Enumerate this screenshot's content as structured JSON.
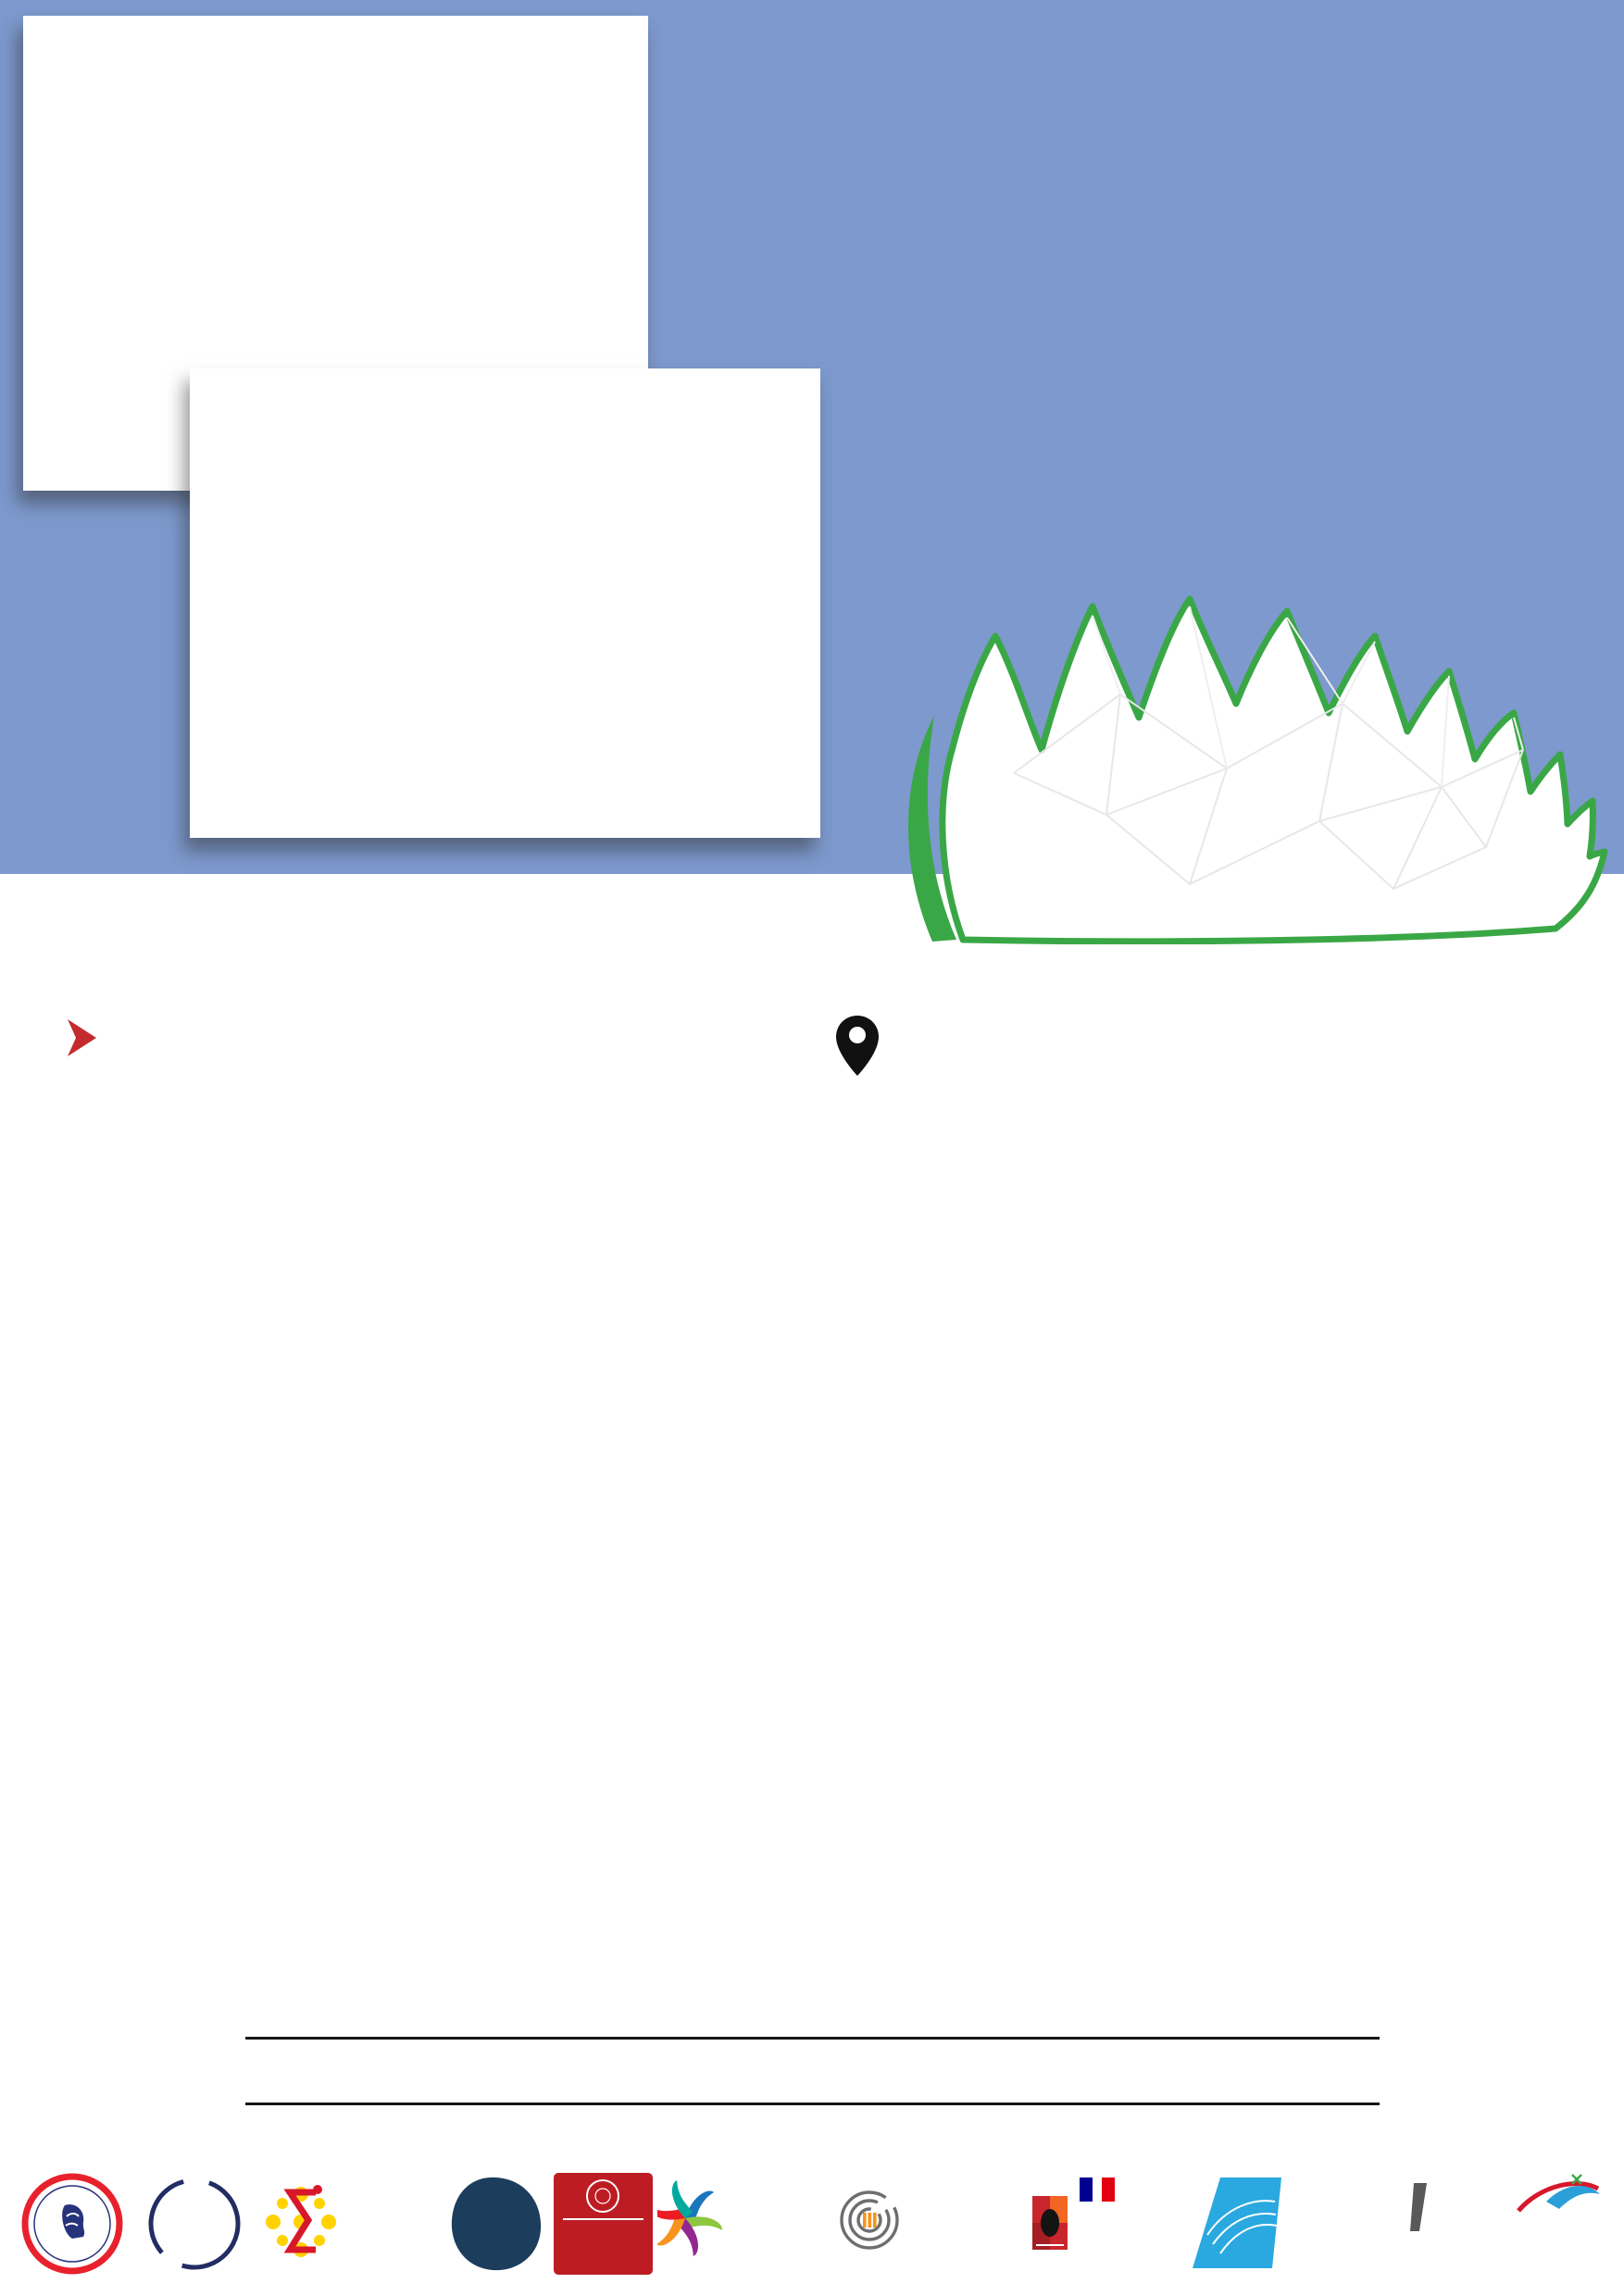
{
  "header": {
    "masterclass": "MASTERCLASS",
    "mint": "MINT",
    "year": "2024"
  },
  "logo": {
    "wordmark": "Mint",
    "subtitle": "Mathematics and Interactions in Toulouse"
  },
  "sessions_header": {
    "label": "SESSIONS",
    "location_line1": "Amphi Schwartz, building 1R3,",
    "location_line2": "Institut de mathématiques of Toulouse"
  },
  "date_header": "January 25th, 2024",
  "sessions": [
    {
      "time": "14h00-15h15",
      "speaker": "Jean-François Coulombel",
      "topic": "Around the central limit theorem (part 1)"
    },
    {
      "time": "15h30-16h45",
      "speaker": "Gregory Faye",
      "topic": "Around the central limit theorem (part 2)"
    }
  ],
  "website": "https://mint.math.univ-toulouse.fr",
  "colors": {
    "band_blue": "#7d99cd",
    "mint_dark_red": "#a2202a",
    "logo_red": "#c1272d",
    "sessions_red": "#c32b2e",
    "green": "#45a64a",
    "url_green": "#3ea44c",
    "leaf_green": "#3aa746",
    "series_blue": "#1b75bc",
    "series_cyan": "#5bc6ea",
    "series_navy": "#232c85"
  },
  "chart_data": [
    {
      "type": "line",
      "title": "",
      "xlabel": "",
      "ylabel": "",
      "xlim": [
        0,
        200
      ],
      "ylim": [
        0,
        0.15
      ],
      "grid": false,
      "legend_position": "top-right",
      "xticks": [
        0,
        50,
        100,
        150,
        200
      ],
      "yticks": [
        0,
        0.05,
        0.1,
        0.15
      ],
      "series": [
        {
          "name": "n = 50",
          "color": "#1b75bc",
          "peaks": [
            {
              "a": 0.121,
              "c": 38,
              "s": 4.2
            }
          ]
        },
        {
          "name": "n = 100",
          "color": "#5bc6ea",
          "peaks": [
            {
              "a": 0.085,
              "c": 75,
              "s": 6.0
            }
          ]
        },
        {
          "name": "n = 150",
          "color": "#232c85",
          "peaks": [
            {
              "a": 0.07,
              "c": 113,
              "s": 7.5
            }
          ]
        }
      ]
    },
    {
      "type": "line",
      "title": "",
      "xlabel": "",
      "ylabel": "",
      "xlim": [
        0,
        200
      ],
      "ylim": [
        -0.2,
        0.3
      ],
      "grid": false,
      "legend_position": "top-right",
      "xticks": [
        0,
        50,
        100,
        150,
        200
      ],
      "yticks": [
        -0.2,
        -0.1,
        0,
        0.1,
        0.2,
        0.3
      ],
      "series": [
        {
          "name": "n = 50",
          "color": "#1b75bc",
          "peaks": [
            {
              "a": 0.026,
              "c": 26.5,
              "s": 1.8
            },
            {
              "a": -0.083,
              "c": 31,
              "s": 2.3
            },
            {
              "a": 0.245,
              "c": 36.5,
              "s": 2.9
            }
          ]
        },
        {
          "name": "n = 100",
          "color": "#5bc6ea",
          "peaks": [
            {
              "a": -0.01,
              "c": 57,
              "s": 1.8
            },
            {
              "a": 0.031,
              "c": 62,
              "s": 2.1
            },
            {
              "a": -0.086,
              "c": 67.5,
              "s": 2.8
            },
            {
              "a": 0.197,
              "c": 73.5,
              "s": 3.6
            }
          ]
        },
        {
          "name": "n = 150",
          "color": "#232c85",
          "peaks": [
            {
              "a": -0.013,
              "c": 90,
              "s": 2.4
            },
            {
              "a": 0.032,
              "c": 97,
              "s": 2.7
            },
            {
              "a": -0.076,
              "c": 103,
              "s": 3.1
            },
            {
              "a": 0.172,
              "c": 110,
              "s": 4.3
            }
          ]
        }
      ]
    }
  ],
  "footer_logos": [
    {
      "name": "investir-lavenir",
      "arc_top": "INVESTIR",
      "arc_bottom": "L'AVENIR"
    },
    {
      "name": "france-2030",
      "title": "FRANCE",
      "year": "2030"
    },
    {
      "name": "institut-de-mathematiques-de-toulouse",
      "line1": "INSTITUT",
      "line2": "de MATHEMATIQUES",
      "line3": "de TOULOUSE"
    },
    {
      "name": "cnrs",
      "wordmark": "cnrs"
    },
    {
      "name": "universite-toulouse-1-capitole",
      "line1": "UNIVERSITÉ",
      "line2": "TOULOUSE 1",
      "line3": "CAPITOLE"
    },
    {
      "name": "universite-toulouse-jean-jaures",
      "line1": "UNIVERSITÉ  TOULOUSE",
      "line2": "Jean Jaurès"
    },
    {
      "name": "universite-toulouse-iii-paul-sabatier",
      "line1": "UNIVERSITÉ",
      "line2": "TOULOUSE III",
      "line3": "PAUL SABATIER",
      "badge": "Université Fédérale"
    },
    {
      "name": "republique-francaise",
      "line1": "RÉPUBLIQUE",
      "line2": "FRANÇAISE",
      "motto1": "Liberté",
      "motto2": "Égalité",
      "motto3": "Fraternité"
    },
    {
      "name": "enac",
      "wordmark": "ENAC"
    },
    {
      "name": "insa-toulouse",
      "wordmark": "INSA",
      "city": "TOULOUSE"
    },
    {
      "name": "isae-supaero",
      "wordmark": "isae",
      "caption": "Institut Supérieur de l'Aéronautique et de l'Espace",
      "line2": "SUPAERO"
    }
  ]
}
